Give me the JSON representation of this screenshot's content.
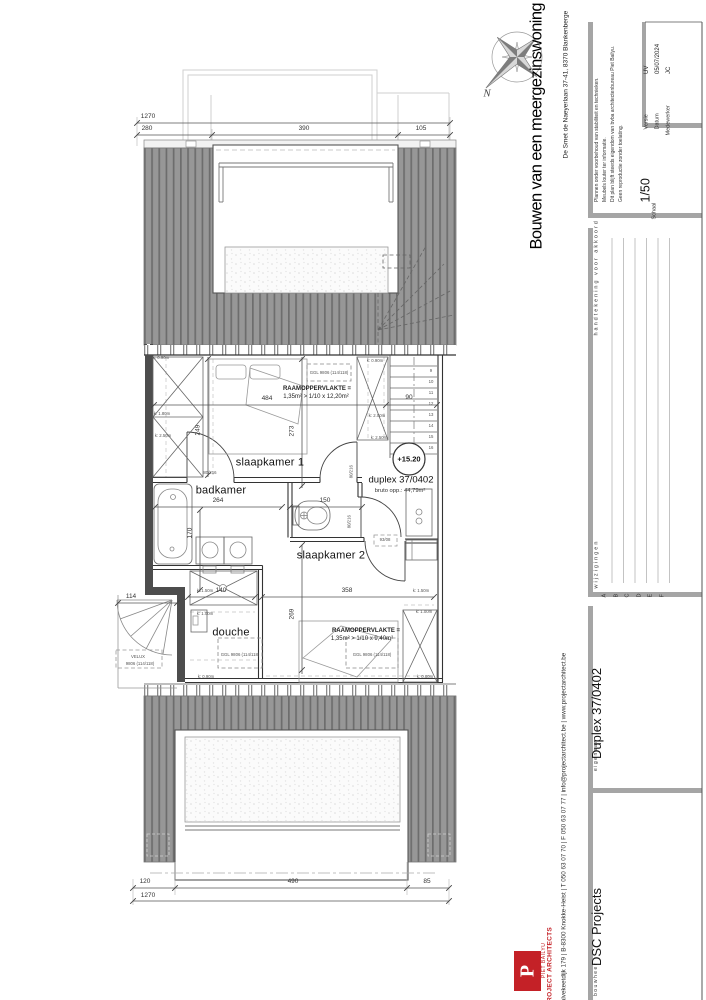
{
  "sheet": {
    "bg": "#ffffff",
    "accent_red": "#c42127",
    "roof_gray": "#979797"
  },
  "title_block": {
    "project_title": "Bouwen van een meergezinswoning",
    "project_address": "De Smet de Naeyerlaan 37-41, 8370 Blankenberge",
    "notes": [
      "Plannen onder voorbehoud van stabiliteit en technieken.",
      "Meubels louter ter informatie.",
      "Dit plan blijft steeds eigendom van bvba architectenbureau Piet Bailyu.",
      "Geen reproductie zonder toelating."
    ],
    "fields": {
      "versie_label": "Versie",
      "versie": "UV",
      "datum_label": "Datum",
      "datum": "05/07/2024",
      "medewerker_label": "Medewerker",
      "medewerker": "JC",
      "schaal_label": "Schaal",
      "schaal": "1/50"
    },
    "revision": {
      "col_changes": "wijzigingen",
      "col_sign": "handtekening voor akkoord",
      "rows": [
        "A",
        "B",
        "C",
        "D",
        "E",
        "F"
      ]
    },
    "parties": {
      "eigenaar_label": "eigenaar",
      "eigenaar": "Duplex 37/0402",
      "bouwheer_label": "bouwheer",
      "bouwheer": "DSC Projects"
    },
    "firm": {
      "name_line1": "PIET BAILYU",
      "name_line2": "PROJECT ARCHITECTS",
      "logo_letter": "P",
      "contact": "Kalvekeetdijk 179 | B-8300 Knokke-Heist | T 050 63 07 70 | F 050 63 07 77 | info@projectarchitect.be | www.projectarchitect.be"
    }
  },
  "compass": {
    "north_label": "N"
  },
  "plan": {
    "rooms": {
      "room1": "slaapkamer 1",
      "room2": "badkamer",
      "room3": "slaapkamer 2",
      "room4": "douche"
    },
    "unit": {
      "level": "+15.20",
      "name": "duplex 37/0402",
      "area": "bruto opp.: 44,79m²"
    },
    "window_notes": {
      "n1a": "RAAMOPPERVLAKTE =",
      "n1b": "1,35m² > 1/10 x 12,20m²",
      "n2a": "RAAMOPPERVLAKTE =",
      "n2b": "1,35m² > 1/10 x 9,40m²"
    },
    "windows": {
      "ggl1": "GGL 9806 (114/118)",
      "ggl2": "GGL 9806 (114/118)",
      "ggl3": "GGL 9806 (114/118)",
      "velux1": "VELUX",
      "velux2": "9806 (114/118)"
    },
    "doors": {
      "d1": "80/216",
      "d2": "80/216",
      "d3": "80/216",
      "lintel": "93/08"
    },
    "heights": {
      "k080": "k: 0.80m",
      "k090": "k: 0.90m",
      "k100": "k: 1.00m",
      "k150": "k: 1.50m",
      "k180": "k: 1.80m",
      "k200": "k: 2.00m",
      "k250": "k: 2.50m"
    },
    "stairs": [
      "9",
      "10",
      "11",
      "12",
      "13",
      "14",
      "15",
      "16"
    ],
    "dims": {
      "t1270": "1270",
      "t280": "280",
      "t390": "390",
      "t105": "105",
      "b1270": "1270",
      "b120": "120",
      "b490": "490",
      "b85": "85",
      "d484": "484",
      "d90": "90",
      "d273": "273",
      "d249": "249",
      "d264": "264",
      "d170": "170",
      "d150": "150",
      "d358": "358",
      "d140": "140",
      "d269": "269",
      "d114": "114"
    }
  }
}
